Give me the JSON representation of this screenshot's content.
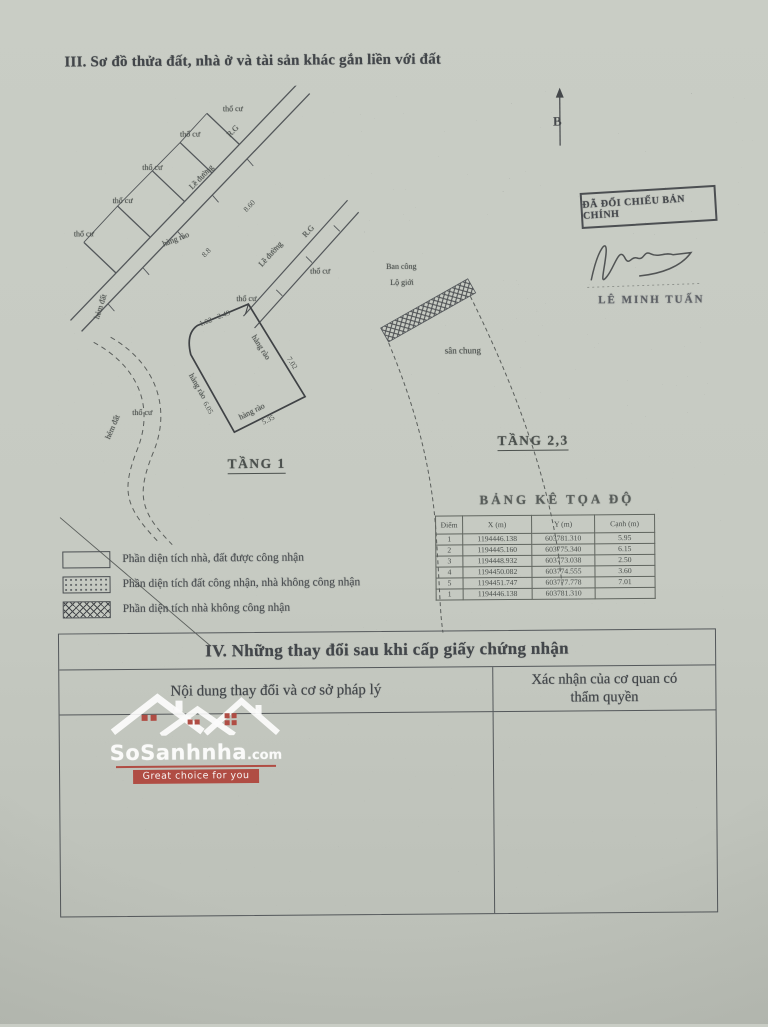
{
  "page": {
    "section3_title": "III. Sơ đồ thửa đất, nhà ở và tài sản khác gắn liền với đất",
    "section4_title": "IV. Những thay đổi sau khi cấp giấy chứng nhận"
  },
  "changes_table": {
    "col_left": "Nội dung thay đổi và cơ sở pháp lý",
    "col_right": "Xác nhận của cơ quan có thẩm quyền"
  },
  "stamp": {
    "text": "ĐÃ ĐỐI CHIẾU BẢN CHÍNH",
    "signer": "LÊ MINH TUẤN"
  },
  "map": {
    "north_label": "B",
    "floor1": "TẦNG 1",
    "floor23": "TẦNG 2,3",
    "labels": {
      "tho_cu": "thổ cư",
      "le_duong": "Lề đường",
      "rg": "R.G",
      "hang_rao": "hàng rào",
      "ban_cong": "Ban công",
      "lo_gioi": "Lộ giới",
      "san_chung": "sân chung",
      "hem_dat": "hẻm đất"
    },
    "dims": {
      "d102": "1.02",
      "d249": "2.49",
      "d605": "6.05",
      "d535": "5.35",
      "d860": "8.60",
      "d88": "8.8",
      "d702": "7.02"
    }
  },
  "coords": {
    "title": "BẢNG KÊ TỌA ĐỘ",
    "headers": [
      "Điểm",
      "X (m)",
      "Y (m)",
      "Cạnh (m)"
    ],
    "rows": [
      {
        "diem": "1",
        "x": "1194446.138",
        "y": "603781.310",
        "canh": "5.95"
      },
      {
        "diem": "2",
        "x": "1194445.160",
        "y": "603775.340",
        "canh": "6.15"
      },
      {
        "diem": "3",
        "x": "1194448.932",
        "y": "603773.038",
        "canh": "2.50"
      },
      {
        "diem": "4",
        "x": "1194450.082",
        "y": "603774.555",
        "canh": "3.60"
      },
      {
        "diem": "5",
        "x": "1194451.747",
        "y": "603777.778",
        "canh": "7.01"
      },
      {
        "diem": "1",
        "x": "1194446.138",
        "y": "603781.310",
        "canh": ""
      }
    ]
  },
  "legend": {
    "items": [
      {
        "label": "Phần diện tích nhà, đất được công nhận"
      },
      {
        "label": "Phần diện tích đất công nhận, nhà không công nhận"
      },
      {
        "label": "Phần diện tích nhà không công nhận"
      }
    ]
  },
  "watermark": {
    "brand": "SoSanhnha",
    "tld": ".com",
    "tagline": "Great choice for you"
  },
  "colors": {
    "paper": "#c6cac2",
    "ink": "#42464a",
    "watermark_accent": "#b0473e"
  }
}
